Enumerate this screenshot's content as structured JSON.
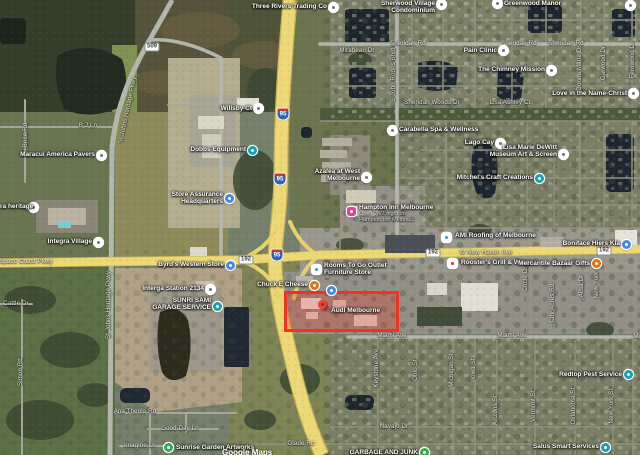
{
  "map": {
    "watermark": {
      "text": "Google Maps"
    },
    "highlight": {
      "label": "Audi Melbourne",
      "color": "#ee3325"
    },
    "shields": [
      {
        "type": "interstate",
        "text": "95",
        "x": 283,
        "y": 114
      },
      {
        "type": "interstate",
        "text": "95",
        "x": 280,
        "y": 179
      },
      {
        "type": "interstate",
        "text": "95",
        "x": 277,
        "y": 255
      },
      {
        "type": "route",
        "text": "192",
        "x": 246,
        "y": 260
      },
      {
        "type": "route",
        "text": "192",
        "x": 433,
        "y": 253
      },
      {
        "type": "route",
        "text": "192",
        "x": 604,
        "y": 251
      },
      {
        "type": "route",
        "text": "509",
        "x": 152,
        "y": 47
      }
    ],
    "street_labels": [
      {
        "t": "Sheridan Rd",
        "x": 408,
        "y": 44
      },
      {
        "t": "Sheridan Rd",
        "x": 519,
        "y": 44
      },
      {
        "t": "Sheridan Rd",
        "x": 566,
        "y": 44
      },
      {
        "t": "Mirabeau Dr",
        "x": 357,
        "y": 51
      },
      {
        "t": "Sheridan Woods Dr",
        "x": 432,
        "y": 103
      },
      {
        "t": "Lisa Ashley Ct",
        "x": 510,
        "y": 103
      },
      {
        "t": "Space Coast Pkwy",
        "x": 26,
        "y": 262
      },
      {
        "t": "W New Haven Ave",
        "x": 486,
        "y": 253
      },
      {
        "t": "Miami Ave",
        "x": 392,
        "y": 336
      },
      {
        "t": "Miami Ave",
        "x": 512,
        "y": 336
      },
      {
        "t": "Miami Ave",
        "x": 648,
        "y": 337
      },
      {
        "t": "Navajo Dr",
        "x": 394,
        "y": 427
      },
      {
        "t": "Ana Theola Rd",
        "x": 135,
        "y": 412
      },
      {
        "t": "Good Day Ln",
        "x": 180,
        "y": 429
      },
      {
        "t": "Imagine Ln",
        "x": 140,
        "y": 446
      },
      {
        "t": "Glade Rd",
        "x": 301,
        "y": 444
      },
      {
        "t": "Cattle Dr",
        "x": 16,
        "y": 304
      },
      {
        "t": "B J Ln",
        "x": 88,
        "y": 126
      },
      {
        "t": "St Johns Heritage Pkwy",
        "x": 109,
        "y": 305,
        "r": -90
      },
      {
        "t": "St Johns Heritage Pkwy",
        "x": 128,
        "y": 110,
        "r": -78
      },
      {
        "t": "Simon Rd",
        "x": 21,
        "y": 372,
        "r": -90
      },
      {
        "t": "Brice Rd",
        "x": 26,
        "y": 135,
        "r": -90
      },
      {
        "t": "S John Rodes Blvd",
        "x": 394,
        "y": 75,
        "r": -90
      },
      {
        "t": "Donna Marie Dr",
        "x": 580,
        "y": 68,
        "r": -90
      },
      {
        "t": "Garwood Dr",
        "x": 604,
        "y": 63,
        "r": -90
      },
      {
        "t": "Fernwood Dr",
        "x": 633,
        "y": 60,
        "r": -90
      },
      {
        "t": "Keystone Ave",
        "x": 377,
        "y": 368,
        "r": -90
      },
      {
        "t": "Ohio St",
        "x": 416,
        "y": 370,
        "r": -90
      },
      {
        "t": "Michigan St",
        "x": 452,
        "y": 370,
        "r": -90
      },
      {
        "t": "Iowa St",
        "x": 474,
        "y": 369,
        "r": -90
      },
      {
        "t": "Arizona St",
        "x": 496,
        "y": 410,
        "r": -90
      },
      {
        "t": "Vermont St",
        "x": 534,
        "y": 406,
        "r": -90
      },
      {
        "t": "Oklahoma St",
        "x": 574,
        "y": 406,
        "r": -90
      },
      {
        "t": "New York St",
        "x": 612,
        "y": 406,
        "r": -90
      },
      {
        "t": "Circle Dr",
        "x": 526,
        "y": 279,
        "r": -90
      },
      {
        "t": "City Acres Rd",
        "x": 553,
        "y": 303,
        "r": -90
      },
      {
        "t": "Alisa Dr",
        "x": 582,
        "y": 286,
        "r": -90
      },
      {
        "t": "New York St",
        "x": 597,
        "y": 281,
        "r": -90
      }
    ],
    "pois": [
      {
        "id": "three-rivers-trading-co",
        "lines": [
          "Three Rivers Trading Co"
        ],
        "align": "right",
        "x": 327,
        "y": 3,
        "icon": {
          "shape": "circle",
          "color": "#ffffff",
          "glyph": "#6b7680",
          "x": 333,
          "y": 7
        }
      },
      {
        "id": "sherwood-village-condominium",
        "lines": [
          "Sherwood Village",
          "Condominium"
        ],
        "align": "right",
        "x": 435,
        "y": 0,
        "icon": {
          "shape": "circle",
          "color": "#ffffff",
          "glyph": "#6b7680",
          "x": 441,
          "y": 4
        }
      },
      {
        "id": "greenwood-manor",
        "lines": [
          "Greenwood Manor"
        ],
        "align": "left",
        "x": 504,
        "y": 0,
        "icon": {
          "shape": "circle",
          "color": "#ffffff",
          "glyph": "#6b7680",
          "x": 497,
          "y": 3
        }
      },
      {
        "id": "poi-northeast",
        "lines": [],
        "icon": {
          "shape": "circle",
          "color": "#ffffff",
          "glyph": "#6b7680",
          "x": 630,
          "y": 5
        }
      },
      {
        "id": "pain-clinic",
        "lines": [
          "Pain Clinic"
        ],
        "align": "right",
        "x": 497,
        "y": 47,
        "icon": {
          "shape": "circle",
          "color": "#ffffff",
          "glyph": "#6b7680",
          "x": 503,
          "y": 50
        }
      },
      {
        "id": "the-chimney-mission",
        "lines": [
          "The Chimney Mission"
        ],
        "align": "right",
        "x": 545,
        "y": 66,
        "icon": {
          "shape": "circle",
          "color": "#ffffff",
          "glyph": "#6b7680",
          "x": 551,
          "y": 70
        }
      },
      {
        "id": "love-in-the-name-christ",
        "lines": [
          "Love in the Name-Christ"
        ],
        "align": "right",
        "x": 627,
        "y": 90,
        "icon": {
          "shape": "circle",
          "color": "#ffffff",
          "glyph": "#6b7680",
          "x": 633,
          "y": 93
        }
      },
      {
        "id": "carabella-spa-wellness",
        "lines": [
          "Carabella Spa & Wellness"
        ],
        "align": "left",
        "x": 399,
        "y": 126,
        "icon": {
          "shape": "circle",
          "color": "#ffffff",
          "glyph": "#6b7680",
          "x": 392,
          "y": 130
        }
      },
      {
        "id": "lago-cay",
        "lines": [
          "Lago Cay"
        ],
        "align": "right",
        "x": 494,
        "y": 139,
        "icon": {
          "shape": "circle",
          "color": "#ffffff",
          "glyph": "#6b7680",
          "x": 500,
          "y": 143
        }
      },
      {
        "id": "dewitt-museum",
        "lines": [
          "Lisa Marie DeWitt",
          "Museum Art & Screen"
        ],
        "align": "right",
        "x": 557,
        "y": 144,
        "icon": {
          "shape": "circle",
          "color": "#ffffff",
          "glyph": "#6b7680",
          "x": 563,
          "y": 154
        }
      },
      {
        "id": "mitchels-craft-creations",
        "lines": [
          "Mitchel's Craft Creations"
        ],
        "align": "right",
        "x": 533,
        "y": 174,
        "icon": {
          "shape": "circle",
          "color": "#17a2ad",
          "glyph": "#ffffff",
          "x": 539,
          "y": 178
        }
      },
      {
        "id": "azalea-at-west-melbourne",
        "lines": [
          "Azalea at West",
          "Melbourne"
        ],
        "align": "right",
        "x": 360,
        "y": 168,
        "icon": {
          "shape": "circle",
          "color": "#ffffff",
          "glyph": "#6b7680",
          "x": 366,
          "y": 177
        }
      },
      {
        "id": "hampton-inn-melbourne",
        "lines": [
          "Hampton Inn Melbourne"
        ],
        "sub": [
          "Open 24/7 night on",
          "Hampton Inn Melbou..."
        ],
        "align": "left",
        "x": 359,
        "y": 204,
        "icon": {
          "shape": "square",
          "color": "#ee3e90",
          "glyph": "#ffffff",
          "x": 351,
          "y": 211
        }
      },
      {
        "id": "willsby-ct",
        "lines": [
          "Willsby Ct"
        ],
        "align": "right",
        "x": 252,
        "y": 105,
        "icon": {
          "shape": "circle",
          "color": "#ffffff",
          "glyph": "#6b7680",
          "x": 258,
          "y": 108
        }
      },
      {
        "id": "dobbs-equipment",
        "lines": [
          "Dobbs Equipment"
        ],
        "align": "right",
        "x": 246,
        "y": 146,
        "icon": {
          "shape": "circle",
          "color": "#17a2ad",
          "glyph": "#ffffff",
          "x": 252,
          "y": 150
        }
      },
      {
        "id": "store-assurance-headquarters",
        "lines": [
          "Store Assurance",
          "Headquarters"
        ],
        "align": "right",
        "x": 223,
        "y": 191,
        "icon": {
          "shape": "circle",
          "color": "#4a86e8",
          "glyph": "#ffffff",
          "x": 229,
          "y": 198
        }
      },
      {
        "id": "maracui-america-pavers",
        "lines": [
          "Maracui America Pavers"
        ],
        "align": "right",
        "x": 95,
        "y": 151,
        "icon": {
          "shape": "circle",
          "color": "#ffffff",
          "glyph": "#6b7680",
          "x": 101,
          "y": 155
        }
      },
      {
        "id": "ra-heritage",
        "lines": [
          "ra heritage"
        ],
        "align": "left",
        "x": 0,
        "y": 203,
        "icon": {
          "shape": "circle",
          "color": "#ffffff",
          "glyph": "#6b7680",
          "x": 33,
          "y": 207
        }
      },
      {
        "id": "integra-village",
        "lines": [
          "Integra Village"
        ],
        "align": "right",
        "x": 92,
        "y": 238,
        "icon": {
          "shape": "circle",
          "color": "#ffffff",
          "glyph": "#6b7680",
          "x": 98,
          "y": 242
        }
      },
      {
        "id": "byrds-western-store",
        "lines": [
          "Byrd's Western Store"
        ],
        "align": "right",
        "x": 224,
        "y": 261,
        "icon": {
          "shape": "circle",
          "color": "#4a86e8",
          "glyph": "#ffffff",
          "x": 230,
          "y": 265
        }
      },
      {
        "id": "interga-station-2134",
        "lines": [
          "Interga Station 2134"
        ],
        "align": "right",
        "x": 204,
        "y": 285,
        "icon": {
          "shape": "circle",
          "color": "#ffffff",
          "glyph": "#6b7680",
          "x": 210,
          "y": 289
        }
      },
      {
        "id": "sunri-sami-garage-service",
        "lines": [
          "SUNRI SAMI",
          "GARAGE SERVICE"
        ],
        "align": "right",
        "x": 211,
        "y": 297,
        "icon": {
          "shape": "circle",
          "color": "#17a2ad",
          "glyph": "#ffffff",
          "x": 217,
          "y": 306
        }
      },
      {
        "id": "rooms-to-go-outlet",
        "lines": [
          "Rooms To Go Outlet",
          "Furniture Store"
        ],
        "align": "left",
        "x": 324,
        "y": 262,
        "icon": {
          "shape": "square",
          "color": "#ffffff",
          "glyph": "#4a86e8",
          "x": 316,
          "y": 269
        }
      },
      {
        "id": "chuck-e-cheese",
        "lines": [
          "Chuck E Cheese"
        ],
        "align": "right",
        "x": 308,
        "y": 281,
        "icon": {
          "shape": "circle",
          "color": "#e8710a",
          "glyph": "#ffffff",
          "x": 314,
          "y": 285
        }
      },
      {
        "id": "dealership-poi",
        "lines": [],
        "icon": {
          "shape": "circle",
          "color": "#4a86e8",
          "glyph": "#ffffff",
          "x": 331,
          "y": 290
        }
      },
      {
        "id": "audi-melbourne",
        "lines": [
          "Audi Melbourne"
        ],
        "align": "left",
        "x": 331,
        "y": 307,
        "icon": {
          "shape": "pin",
          "color": "#ea4335",
          "x": 322,
          "y": 306
        }
      },
      {
        "id": "ami-roofing-of-melbourne",
        "lines": [
          "AMI Roofing of Melbourne"
        ],
        "align": "left",
        "x": 455,
        "y": 232,
        "icon": {
          "shape": "square",
          "color": "#ffffff",
          "glyph": "#4a86e8",
          "x": 446,
          "y": 237
        }
      },
      {
        "id": "roosters-grill-wings",
        "lines": [
          "Rooster's Grill & Wings"
        ],
        "align": "left",
        "x": 461,
        "y": 259,
        "icon": {
          "shape": "square",
          "color": "#ffffff",
          "glyph": "#d93025",
          "x": 452,
          "y": 263
        }
      },
      {
        "id": "mercantile-bazaar-gifts",
        "lines": [
          "Mercantile Bazaar Gifts"
        ],
        "align": "right",
        "x": 590,
        "y": 260,
        "icon": {
          "shape": "circle",
          "color": "#e8710a",
          "glyph": "#ffffff",
          "x": 596,
          "y": 263
        }
      },
      {
        "id": "boniface-hiers-kia",
        "lines": [
          "Boniface Hiers Kia"
        ],
        "align": "right",
        "x": 620,
        "y": 240,
        "icon": {
          "shape": "circle",
          "color": "#4a86e8",
          "glyph": "#ffffff",
          "x": 626,
          "y": 244
        }
      },
      {
        "id": "redtop-pest-service",
        "lines": [
          "Redtop Pest Service"
        ],
        "align": "right",
        "x": 622,
        "y": 371,
        "icon": {
          "shape": "circle",
          "color": "#17a2ad",
          "glyph": "#ffffff",
          "x": 628,
          "y": 374
        }
      },
      {
        "id": "salus-smart-services",
        "lines": [
          "Salus Smart Services"
        ],
        "align": "right",
        "x": 599,
        "y": 443,
        "icon": {
          "shape": "circle",
          "color": "#17a2ad",
          "glyph": "#ffffff",
          "x": 605,
          "y": 447
        }
      },
      {
        "id": "garbage-and-junk",
        "lines": [
          "GARBAGE AND JUNK"
        ],
        "align": "right",
        "x": 418,
        "y": 449,
        "icon": {
          "shape": "circle",
          "color": "#34a853",
          "glyph": "#ffffff",
          "x": 424,
          "y": 452
        }
      },
      {
        "id": "sunrise-garden-artworks",
        "lines": [
          "Sunrise Garden Artworks"
        ],
        "align": "left",
        "x": 176,
        "y": 444,
        "icon": {
          "shape": "circle",
          "color": "#34a853",
          "glyph": "#ffffff",
          "x": 168,
          "y": 447
        }
      }
    ]
  }
}
